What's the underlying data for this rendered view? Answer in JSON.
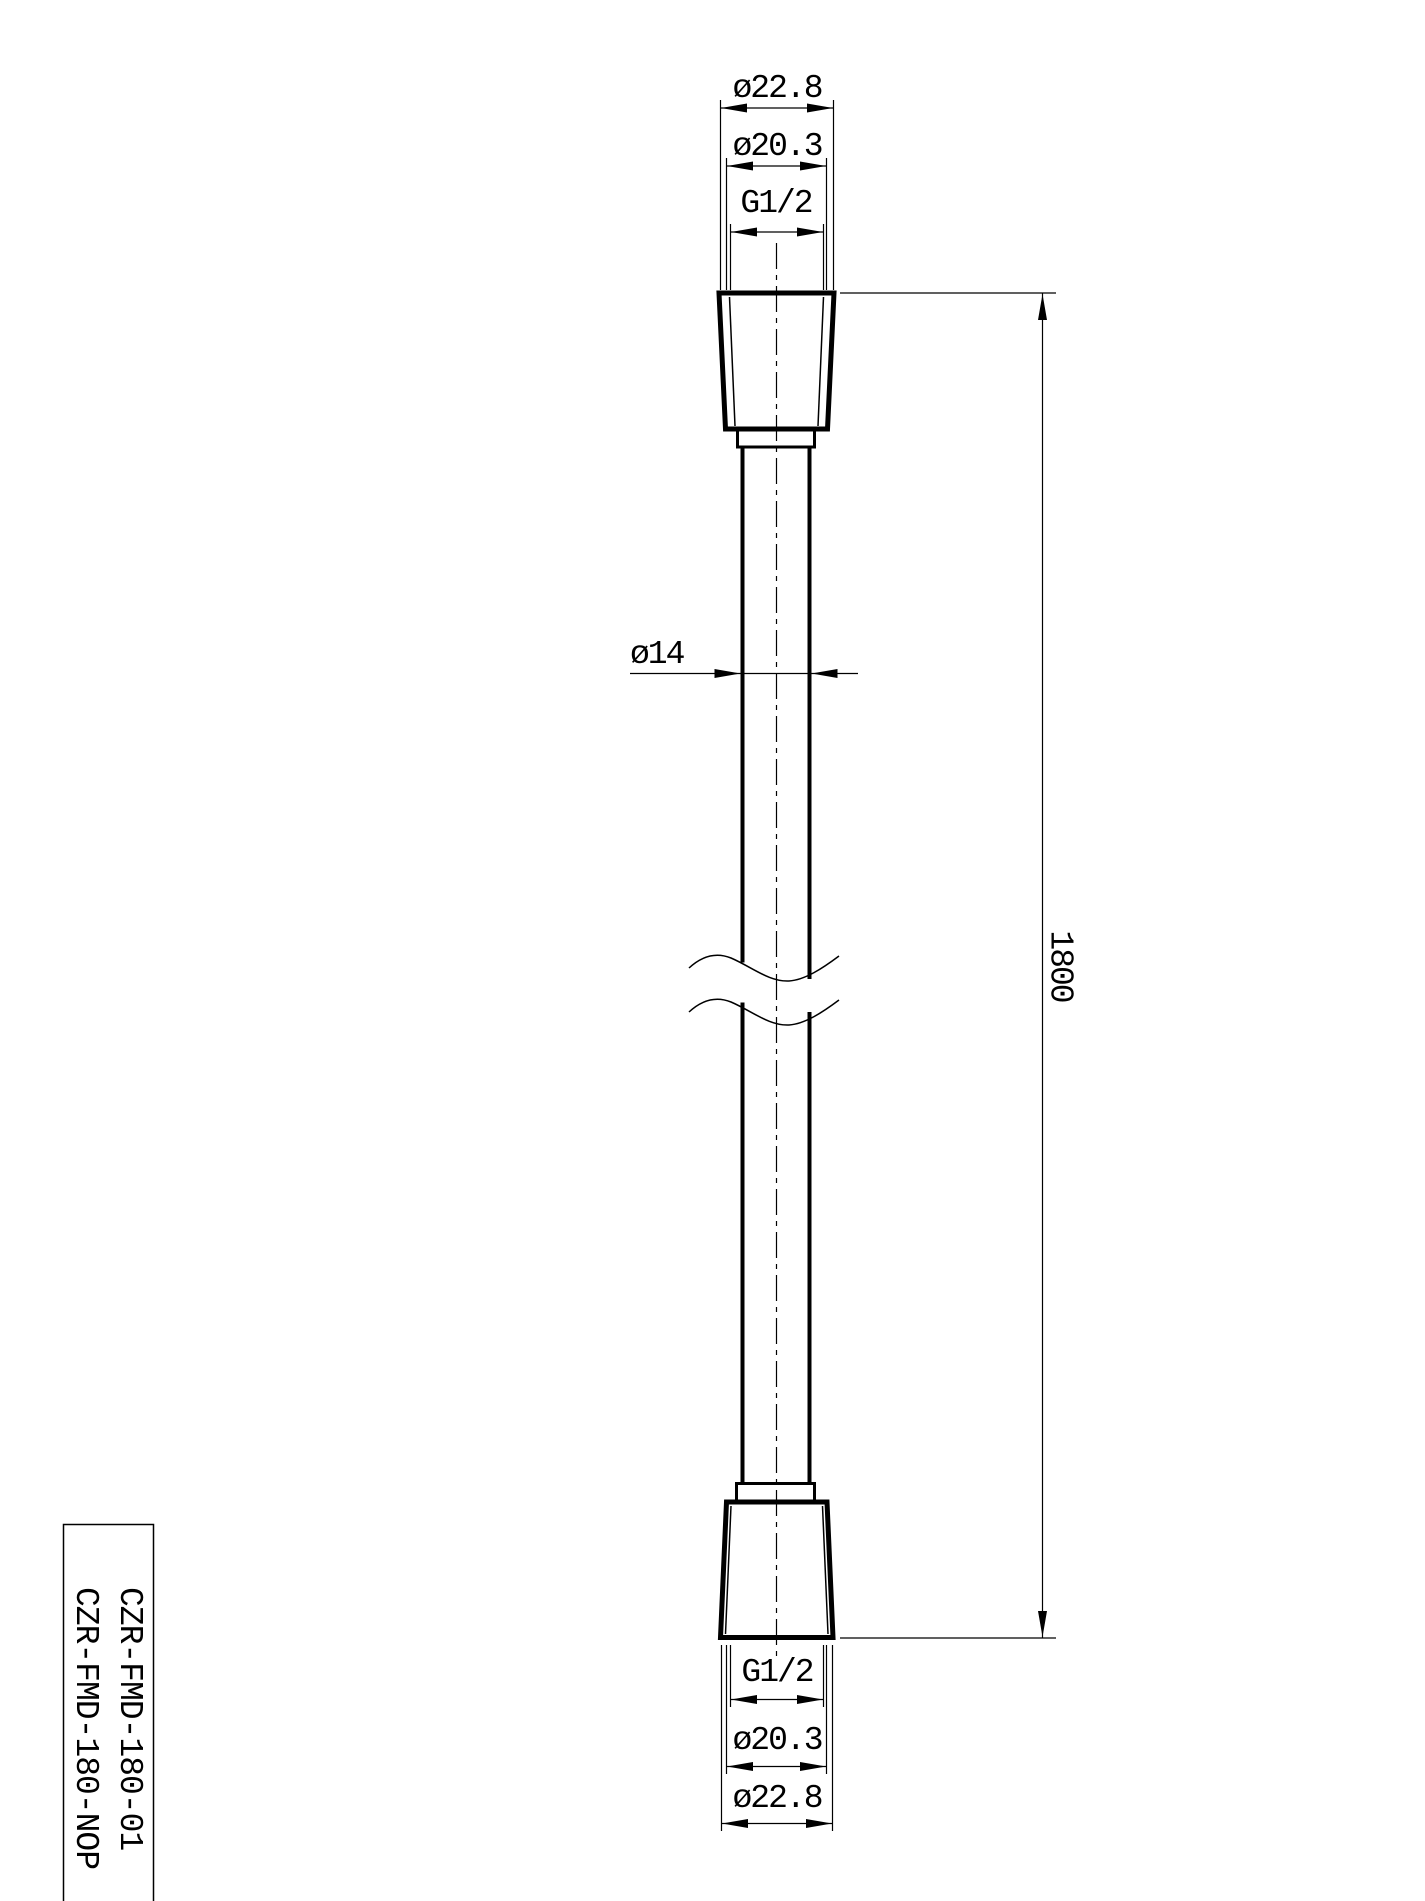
{
  "page": {
    "background_color": "#ffffff",
    "line_color": "#000000"
  },
  "dimensions": {
    "top": {
      "outer_diameter": "ø22.8",
      "thread_outer_diameter": "ø20.3",
      "thread_size": "G1/2"
    },
    "hose": {
      "diameter": "ø14",
      "length": "1800"
    },
    "bottom": {
      "thread_size": "G1/2",
      "thread_outer_diameter": "ø20.3",
      "outer_diameter": "ø22.8"
    }
  },
  "title_block": {
    "part_numbers": [
      "CZR-FMD-180-01",
      "CZR-FMD-180-NOP"
    ]
  }
}
